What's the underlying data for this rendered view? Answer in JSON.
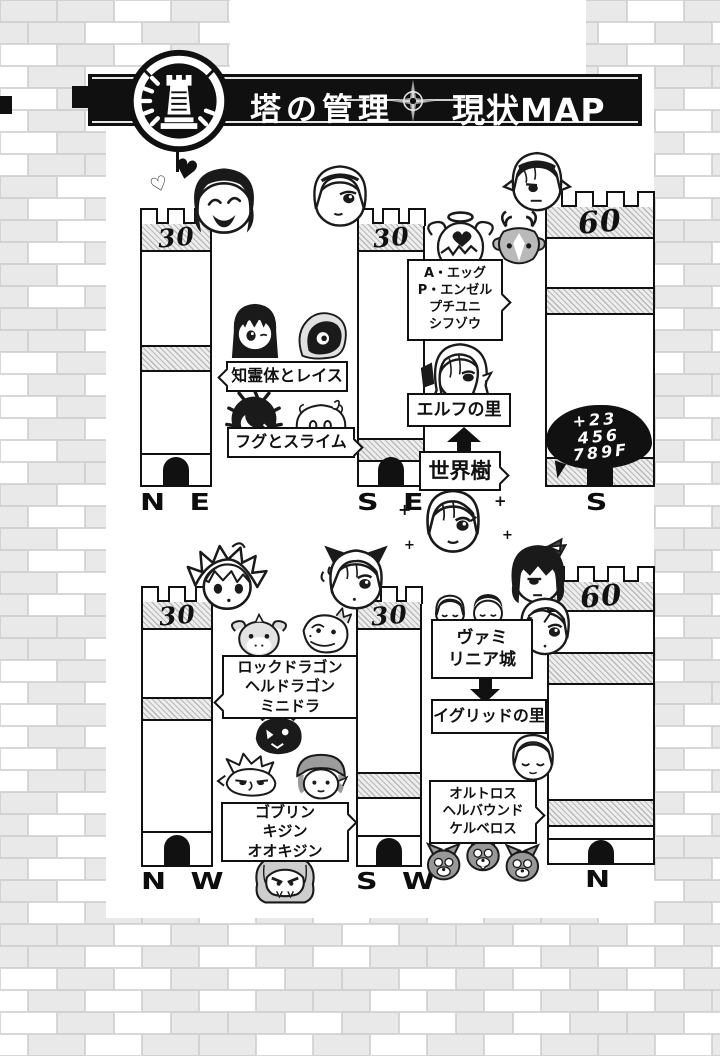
{
  "banner": {
    "title_left": "塔の管理",
    "title_right": "現状MAP"
  },
  "towers": [
    {
      "id": "ne",
      "floor": "30",
      "direction": "N E"
    },
    {
      "id": "se",
      "floor": "30",
      "direction": "S E"
    },
    {
      "id": "s",
      "floor": "60",
      "direction": "S"
    },
    {
      "id": "nw",
      "floor": "30",
      "direction": "N W"
    },
    {
      "id": "sw",
      "floor": "30",
      "direction": "S W"
    },
    {
      "id": "n",
      "floor": "60",
      "direction": "N"
    }
  ],
  "bubbles": {
    "spirits": "知霊体とレイス",
    "fugu_slime": "フグとスライム",
    "angel_group": [
      "A・エッグ",
      "P・エンゼル",
      "プチユニ",
      "シフゾウ"
    ],
    "elf_village": "エルフの里",
    "world_tree": "世界樹",
    "floor_blob": [
      "+23",
      "456",
      "789F"
    ],
    "dragons": [
      "ロックドラゴン",
      "ヘルドラゴン",
      "ミニドラ"
    ],
    "goblins": [
      "ゴブリン",
      "キジン",
      "オオキジン"
    ],
    "vamilinia": [
      "ヴァミ",
      "リニア城"
    ],
    "igrid_village": "イグリッドの里",
    "hellhounds": [
      "オルトロス",
      "ヘルバウンド",
      "ケルベロス"
    ]
  },
  "decorations": {
    "heart_filled": "♥",
    "heart_outline": "♡",
    "sparkle": "+"
  },
  "characters": [
    "laughing-dark-hair-chibi",
    "hearts",
    "blonde-hairband-chibi",
    "elf-hairband-chibi",
    "black-hair-girl-chibi",
    "wraith",
    "pufferfish",
    "slime",
    "angel-egg",
    "deer",
    "elf-long-hair-chibi",
    "sparkle-girl-chibi",
    "spiky-hair-chibi",
    "cat-ear-chibi",
    "rock-dragon",
    "pale-dragon",
    "dark-dragon",
    "goblin",
    "capped-goblin",
    "ogre",
    "bow-girl-chibi",
    "blonde-girl-chibi",
    "mini-chibi-light",
    "mini-chibi-dark",
    "sleeping-chibi",
    "three-hound-heads"
  ]
}
